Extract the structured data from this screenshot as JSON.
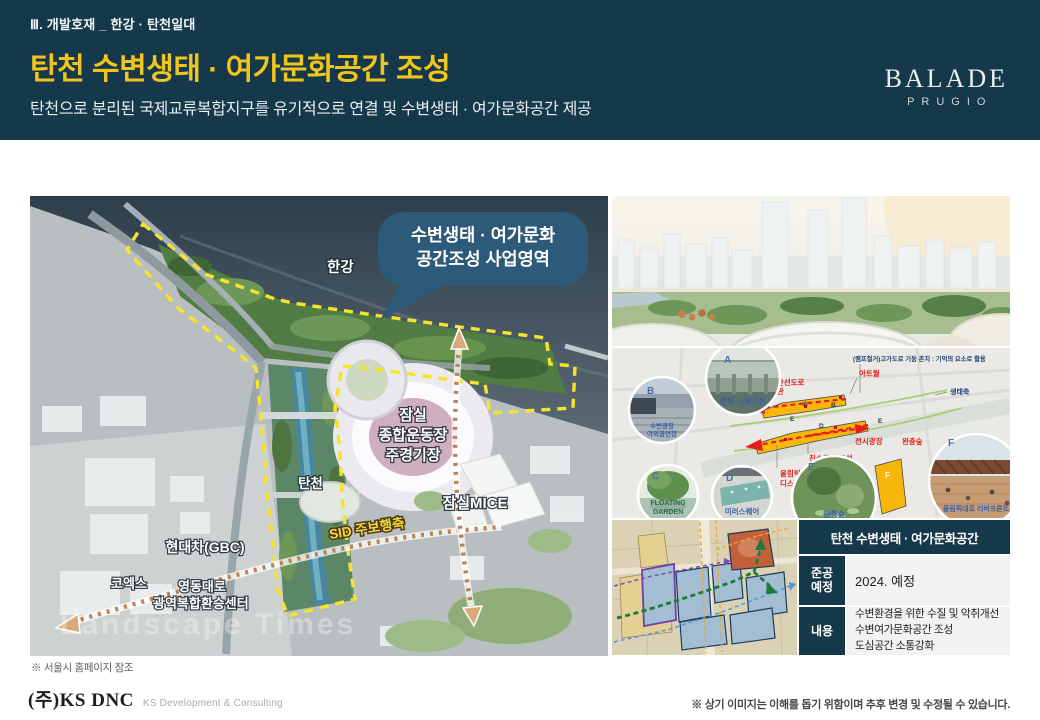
{
  "header": {
    "kicker": "Ⅲ. 개발호재 _ 한강 · 탄천일대",
    "title": "탄천 수변생태 · 여가문화공간 조성",
    "subtitle": "탄천으로 분리된 국제교류복합지구를 유기적으로 연결 및  수변생태 · 여가문화공간 제공",
    "brand_name": "BALADE",
    "brand_sub": "PRUGIO"
  },
  "colors": {
    "header_bg": "#16384B",
    "title_yellow": "#F2C51D",
    "boundary_yellow": "#F5E32E",
    "bubble_navy": "#2D5A78",
    "accent_red": "#E31E1E"
  },
  "main_map": {
    "han_river_label": "한강",
    "tancheon_label": "탄천",
    "bubble_line1": "수변생태 · 여가문화",
    "bubble_line2": "공간조성 사업영역",
    "stadium_line1": "잠실",
    "stadium_line2": "종합운동장",
    "stadium_line3": "주경기장",
    "sid_axis_label": "SID 주보행축",
    "mice_label": "잠실MICE",
    "gbc_label": "현대차(GBC)",
    "coex_label": "코엑스",
    "yeongdong_line1": "영동대로",
    "yeongdong_line2": "광역복합환승센터",
    "watermark": "Landscape Times",
    "source_note": "※ 서울시 홈페이지 참조"
  },
  "diagram": {
    "callouts": [
      {
        "letter": "A",
        "label": "블루 시워가든"
      },
      {
        "letter": "B",
        "label_line1": "수변광장",
        "label_line2": "야외공연장"
      },
      {
        "letter": "C",
        "label_line1": "FLOATING",
        "label_line2": "GARDEN"
      },
      {
        "letter": "D",
        "label": "미러스퀘어"
      },
      {
        "letter": "E",
        "label": "완충숲"
      },
      {
        "letter": "F",
        "label": "올림픽대로 리버프론트"
      }
    ],
    "map_letters": [
      "A",
      "B",
      "D",
      "E",
      "E",
      "F"
    ],
    "annotations": {
      "top_note": "(램프철거)고가도로 기둥 존치 : 기억의 요소로 활용",
      "art_wall": "아트월",
      "expressway_line1": "동부간선도로",
      "expressway_line2": "미술관",
      "eco_axis": "생태축",
      "exhibition_plaza": "전시광장",
      "buffer_forest": "완충숲",
      "waterfront_space": "친수공간 조성",
      "display_mall_line1": "올림픽",
      "display_mall_line2": "디스플레이몰"
    }
  },
  "info_table": {
    "title": "탄천 수변생태 · 여가문화공간",
    "rows": [
      {
        "label_line1": "준공",
        "label_line2": "예정",
        "value": "2024. 예정"
      },
      {
        "label_line1": "내용",
        "value_lines": [
          "수변환경을 위한 수질 및 악취개선",
          "수변여가문화공간 조성",
          "도심공간 소통강화"
        ]
      }
    ]
  },
  "footer": {
    "company": "(주)KS DNC",
    "company_sub": "KS Development & Consulting",
    "disclaimer": "※ 상기 이미지는 이해를 돕기 위함이며 추후 변경 및 수정될 수 있습니다."
  }
}
